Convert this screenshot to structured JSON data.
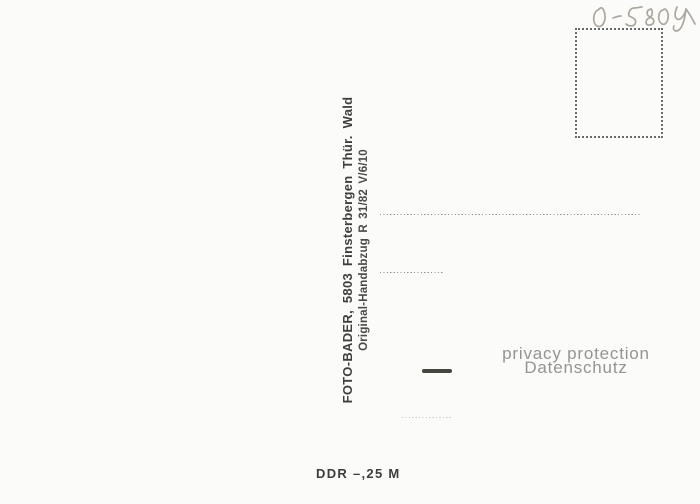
{
  "postcard": {
    "type": "postcard-back-scan",
    "background_color": "#fbfbf9",
    "ink_color": "#3f3f3f",
    "pencil_color": "#aca69e",
    "handwriting": {
      "text": "0-5804"
    },
    "stamp_box": {
      "style": "dotted-rectangle"
    },
    "publisher": {
      "line1": "FOTO-BADER,  5803  Finsterbergen  Thür. Wald",
      "line2": "Original-Handabzug  R 31/82  V/6/10"
    },
    "address_lines": {
      "count": 3
    },
    "watermark": {
      "line_en": "privacy protection",
      "line_de": "Datenschutz",
      "color": "#949494"
    },
    "price": {
      "text": "DDR –,25 M"
    }
  }
}
